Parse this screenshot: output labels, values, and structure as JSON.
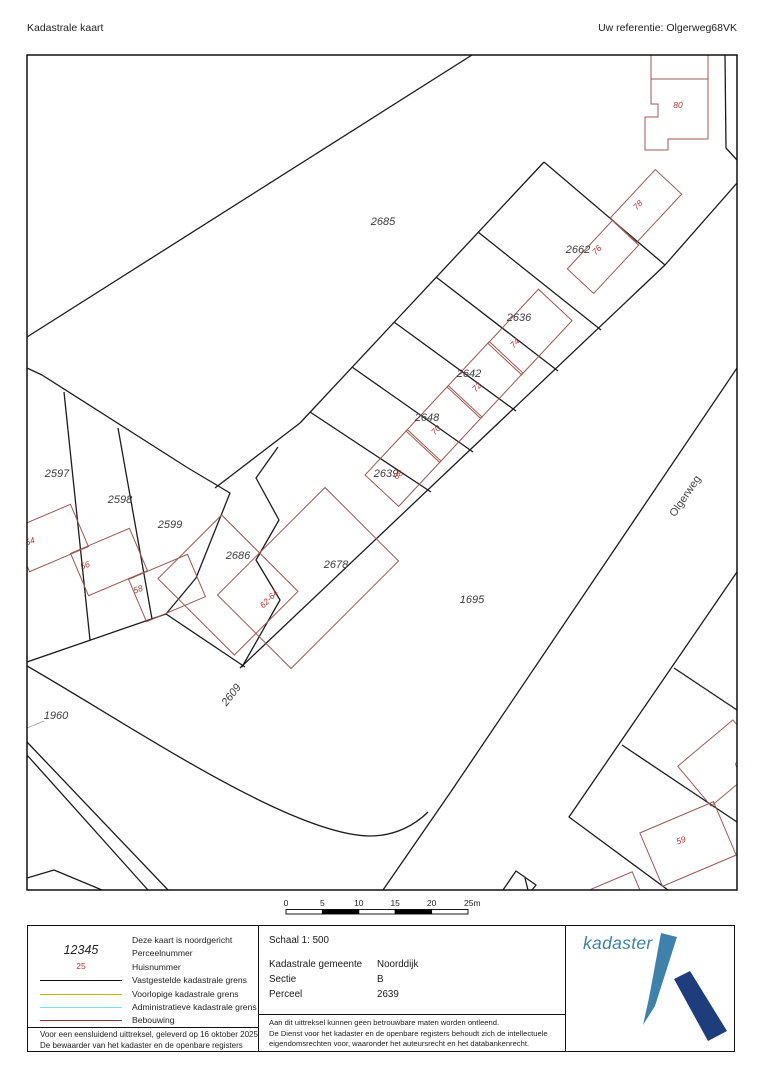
{
  "header": {
    "title": "Kadastrale kaart",
    "reference": "Uw referentie: Olgerweg68VK"
  },
  "map": {
    "colors": {
      "boundary": "#1c1c1c",
      "building": "#9b5a55",
      "house_number": "#b03431",
      "parcel_number": "#3c3c3c",
      "street": "#444444"
    },
    "frame": {
      "x": 27,
      "y": 55,
      "w": 710,
      "h": 835
    },
    "boundary_paths": [
      {
        "d": "M27,337 L472,55"
      },
      {
        "d": "M725,55 L726,148 L737,160"
      },
      {
        "d": "M737,368 L450,793 L383,890"
      },
      {
        "d": "M27,666 C130,725 290,835 370,836 C395,836 415,825 428,812"
      },
      {
        "d": "M27,742 L168,890"
      },
      {
        "d": "M27,755 L148,890"
      },
      {
        "d": "M27,878 L54,870 L102,890"
      },
      {
        "d": "M544,162 L300,423"
      },
      {
        "d": "M544,162 L665,265"
      },
      {
        "d": "M737,183 L665,265 L240,668"
      },
      {
        "d": "M478,232 L601,330"
      },
      {
        "d": "M436,277 L558,371"
      },
      {
        "d": "M394,322 L516,411"
      },
      {
        "d": "M352,367 L473,452"
      },
      {
        "d": "M310,412 L431,492"
      },
      {
        "d": "M300,423 L215,488"
      },
      {
        "d": "M27,368 L42,375 L188,468 L230,493 L196,578 L166,614 L27,662"
      },
      {
        "d": "M64,392 L90,640"
      },
      {
        "d": "M118,428 L152,619"
      },
      {
        "d": "M166,614 L245,667"
      },
      {
        "d": "M278,447 L256,478 L279,520 L256,560 L280,600 L242,667"
      },
      {
        "d": "M737,572 L569,817 L668,890"
      },
      {
        "d": "M674,668 L737,710"
      },
      {
        "d": "M622,745 L737,822"
      },
      {
        "d": "M503,890 L516,871 L536,885 L532,890"
      },
      {
        "d": "M525,878 L528,890"
      },
      {
        "d": "M44,721 L27,728",
        "c": "#999999",
        "w": 0.8
      }
    ],
    "buildings": [
      {
        "name": "78",
        "cx": 646,
        "cy": 206,
        "w": 66,
        "h": 36,
        "rot": -47
      },
      {
        "name": "76",
        "cx": 603,
        "cy": 257,
        "w": 66,
        "h": 36,
        "rot": -47
      },
      {
        "name": "74",
        "cx": 530,
        "cy": 332,
        "w": 74,
        "h": 46,
        "rot": -47
      },
      {
        "name": "72",
        "cx": 485,
        "cy": 380,
        "w": 62,
        "h": 46,
        "rot": -47
      },
      {
        "name": "70",
        "cx": 444,
        "cy": 424,
        "w": 62,
        "h": 46,
        "rot": -47
      },
      {
        "name": "68",
        "cx": 403,
        "cy": 468,
        "w": 62,
        "h": 46,
        "rot": -47
      },
      {
        "name": "54",
        "cx": 50,
        "cy": 538,
        "w": 64,
        "h": 46,
        "rot": -23
      },
      {
        "name": "56",
        "cx": 109,
        "cy": 562,
        "w": 64,
        "h": 46,
        "rot": -23
      },
      {
        "name": "58",
        "cx": 167,
        "cy": 588,
        "w": 64,
        "h": 46,
        "rot": -23
      },
      {
        "name": "2686-building",
        "cx": 228,
        "cy": 585,
        "w": 90,
        "h": 108,
        "rot": -45
      },
      {
        "name": "62-64",
        "cx": 308,
        "cy": 578,
        "w": 152,
        "h": 104,
        "rot": -45
      },
      {
        "name": "59",
        "cx": 688,
        "cy": 844,
        "w": 80,
        "h": 58,
        "rot": -23
      },
      {
        "name": "61",
        "cx": 722,
        "cy": 763,
        "w": 72,
        "h": 52,
        "rot": -40
      },
      {
        "name": "edge-building",
        "cx": 615,
        "cy": 903,
        "w": 56,
        "h": 44,
        "rot": -23
      }
    ],
    "building_paths": [
      {
        "d": "M651,55 L651,104 L658,104 L658,117 L645,117 L645,150 L668,150 L668,139 L708,139 L708,55"
      },
      {
        "d": "M651,79 L708,79"
      }
    ],
    "parcel_labels": [
      {
        "text": "2685",
        "x": 383,
        "y": 225
      },
      {
        "text": "2662",
        "x": 578,
        "y": 253
      },
      {
        "text": "2636",
        "x": 519,
        "y": 321
      },
      {
        "text": "2642",
        "x": 469,
        "y": 377
      },
      {
        "text": "2648",
        "x": 427,
        "y": 421
      },
      {
        "text": "2639",
        "x": 386,
        "y": 477
      },
      {
        "text": "2597",
        "x": 57,
        "y": 477
      },
      {
        "text": "2598",
        "x": 120,
        "y": 503
      },
      {
        "text": "2599",
        "x": 170,
        "y": 528
      },
      {
        "text": "2686",
        "x": 238,
        "y": 559
      },
      {
        "text": "2678",
        "x": 336,
        "y": 568
      },
      {
        "text": "2609",
        "x": 234,
        "y": 697,
        "rot": -52
      },
      {
        "text": "1695",
        "x": 472,
        "y": 603
      },
      {
        "text": "1960",
        "x": 56,
        "y": 719
      }
    ],
    "house_labels": [
      {
        "text": "80",
        "x": 678,
        "y": 108
      },
      {
        "text": "78",
        "x": 640,
        "y": 207,
        "rot": -47
      },
      {
        "text": "76",
        "x": 599,
        "y": 252,
        "rot": -47
      },
      {
        "text": "74",
        "x": 517,
        "y": 345,
        "rot": -47
      },
      {
        "text": "72",
        "x": 479,
        "y": 389,
        "rot": -47
      },
      {
        "text": "70",
        "x": 438,
        "y": 432,
        "rot": -47
      },
      {
        "text": "68",
        "x": 400,
        "y": 477,
        "rot": -40
      },
      {
        "text": "54",
        "x": 31,
        "y": 544,
        "rot": -20
      },
      {
        "text": "56",
        "x": 86,
        "y": 568,
        "rot": -20
      },
      {
        "text": "58",
        "x": 139,
        "y": 592,
        "rot": -20
      },
      {
        "text": "62-64",
        "x": 271,
        "y": 601,
        "rot": -45
      },
      {
        "text": "59",
        "x": 682,
        "y": 843,
        "rot": -20
      },
      {
        "text": "61",
        "x": 741,
        "y": 766,
        "rot": -40
      }
    ],
    "street_labels": [
      {
        "text": "Olgerweg",
        "x": 688,
        "y": 498,
        "rot": -56
      }
    ]
  },
  "scalebar": {
    "labels": [
      "0",
      "5",
      "10",
      "15",
      "20",
      "25m"
    ],
    "x0": 286,
    "label_y": 906,
    "bar_y": 909.5,
    "segment_w": 36.4,
    "h": 4.5,
    "fill_pattern": [
      "#ffffff",
      "#000000",
      "#ffffff",
      "#000000",
      "#ffffff"
    ]
  },
  "legend": {
    "north_note": "Deze kaart is noordgericht",
    "items": [
      {
        "symbol_text": "12345",
        "symbol_class": "sym-parcel",
        "label": "Perceelnummer"
      },
      {
        "symbol_text": "25",
        "symbol_class": "sym-huis",
        "label": "Huisnummer"
      },
      {
        "line_color": "#111111",
        "label": "Vastgestelde kadastrale grens"
      },
      {
        "line_color": "#c8b400",
        "label": "Voorlopige kadastrale grens"
      },
      {
        "line_color": "#7fdfdf",
        "label": "Administratieve kadastrale grens"
      },
      {
        "line_color": "#8b2f2f",
        "label": "Bebouwing"
      }
    ],
    "notes": [
      "Voor een eensluidend uittreksel, geleverd op 16 oktober 2025",
      "De bewaarder van het kadaster en de openbare registers"
    ]
  },
  "details": {
    "schaal": "Schaal 1: 500",
    "rows": [
      {
        "label": "Kadastrale gemeente",
        "value": "Noorddijk"
      },
      {
        "label": "Sectie",
        "value": "B"
      },
      {
        "label": "Perceel",
        "value": "2639"
      }
    ],
    "fineprint": [
      "Aan dit uittreksel kunnen geen betrouwbare maten worden ontleend.",
      "De Dienst voor het kadaster en de openbare registers behoudt zich de intellectuele",
      "eigendomsrechten voor, waaronder het auteursrecht en het databankenrecht."
    ]
  },
  "logo": {
    "text": "kadaster",
    "light_blue": "#3e82ab",
    "navy": "#1e3d7c"
  }
}
